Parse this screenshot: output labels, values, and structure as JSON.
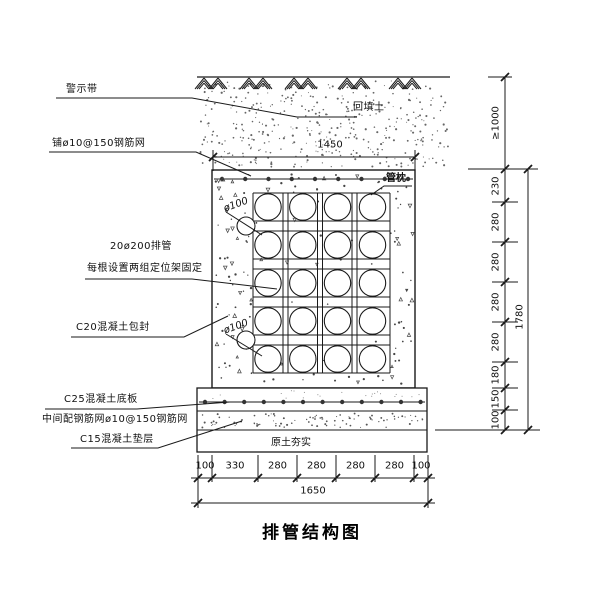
{
  "title": "排管结构图",
  "labels": {
    "warning_tape": "警示带",
    "top_mesh": "铺ø10@150钢筋网",
    "backfill": "回填土",
    "pipe_pillow": "管枕",
    "pipes_line1": "20ø200排管",
    "pipes_line2": "每根设置两组定位架固定",
    "encasement": "C20混凝土包封",
    "base_slab": "C25混凝土底板",
    "mid_mesh": "中间配钢筋网ø10@150钢筋网",
    "cushion": "C15混凝土垫层",
    "compacted_soil": "原土夯实",
    "pipe_dia": "ø100"
  },
  "dimensions": {
    "top_width": "1450",
    "right": {
      "cover": "≥1000",
      "segments": [
        "230",
        "280",
        "280",
        "280",
        "280",
        "180",
        "150",
        "100"
      ],
      "total": "1780"
    },
    "bottom": {
      "segments": [
        "100",
        "330",
        "280",
        "280",
        "280",
        "280",
        "100"
      ],
      "total": "1650"
    }
  },
  "drawing": {
    "pipe_rows": 5,
    "pipe_cols": 4,
    "line_color": "#1a1a1a",
    "speck_color": "#555555"
  }
}
